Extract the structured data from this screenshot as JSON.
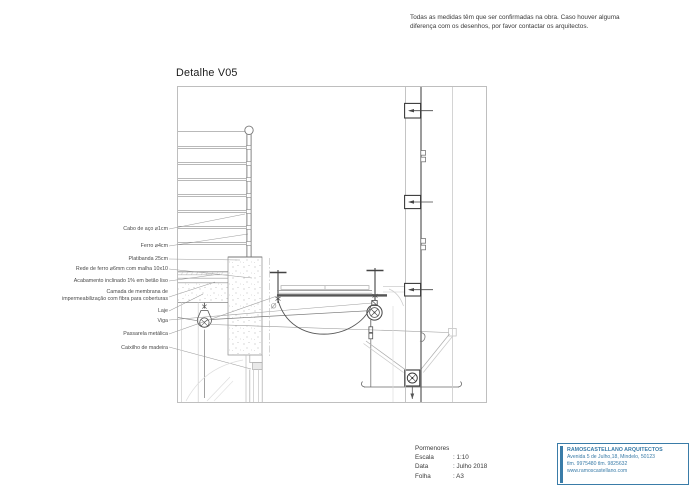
{
  "note": "Todas as medidas têm que ser confirmadas na obra. Caso houver alguma diferença com os desenhos, por favor contactar os arquitectos.",
  "title": "Detalhe V05",
  "labels": [
    {
      "text": "Cabo de aço ⌀1cm"
    },
    {
      "text": "Ferro ⌀4cm"
    },
    {
      "text": "Platibanda 25cm"
    },
    {
      "text": "Rede de ferro ⌀6mm com malha 10x10"
    },
    {
      "text": "Acabamento inclinado 1% em betão liso"
    },
    {
      "text": "Camada de membrana de\nimpermeabilização com fibra para coberturas"
    },
    {
      "text": "Laje"
    },
    {
      "text": "Viga"
    },
    {
      "text": "Passarela metálica"
    },
    {
      "text": "Caixilho de madeira"
    }
  ],
  "titleblock": {
    "heading": "Pormenores",
    "rows": [
      {
        "label": "Escala",
        "value": ": 1:10"
      },
      {
        "label": "Data",
        "value": ": Julho 2018"
      },
      {
        "label": "Folha",
        "value": ": A3"
      }
    ]
  },
  "firm": {
    "name": "RAMOSCASTELLANO ARQUITECTOS",
    "address": "Avenida 5 de Julho,18, Mindelo, 50123",
    "phones": "tlm. 9975480 tlm. 9825632",
    "website": "www.ramoscastellano.com"
  },
  "colors": {
    "accent": "#3a7ca8"
  }
}
